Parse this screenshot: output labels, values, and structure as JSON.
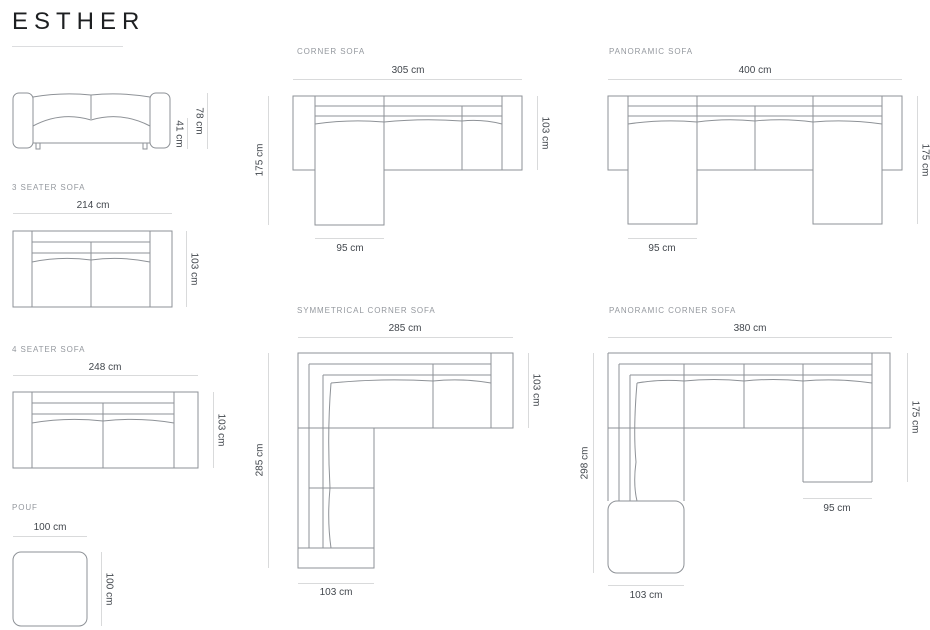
{
  "page": {
    "title": "ESTHER"
  },
  "sections": {
    "front_view": {
      "height": "78 cm",
      "seat_height": "41 cm"
    },
    "three_seater": {
      "label": "3 SEATER SOFA",
      "width": "214 cm",
      "depth": "103 cm"
    },
    "four_seater": {
      "label": "4 SEATER SOFA",
      "width": "248 cm",
      "depth": "103 cm"
    },
    "pouf": {
      "label": "POUF",
      "width": "100 cm",
      "depth": "100 cm"
    },
    "corner_sofa": {
      "label": "CORNER SOFA",
      "width": "305 cm",
      "depth_right": "103 cm",
      "length_left": "175 cm",
      "chaise_width": "95 cm"
    },
    "panoramic_sofa": {
      "label": "PANORAMIC SOFA",
      "width": "400 cm",
      "length_right": "175 cm",
      "chaise_width": "95 cm"
    },
    "symmetrical_corner_sofa": {
      "label": "SYMMETRICAL CORNER SOFA",
      "width": "285 cm",
      "depth_right": "103 cm",
      "length_left": "285 cm",
      "bottom_width": "103 cm"
    },
    "panoramic_corner_sofa": {
      "label": "PANORAMIC CORNER SOFA",
      "width": "380 cm",
      "depth_right": "175 cm",
      "length_left": "298 cm",
      "chaise_width": "95 cm",
      "bottom_width": "103 cm"
    }
  },
  "colors": {
    "drawing_line": "#8e9297",
    "dimension_line": "#d9dadb",
    "section_label": "#94989e",
    "dimension_text": "#42474d",
    "title_text": "#1d1f21"
  }
}
